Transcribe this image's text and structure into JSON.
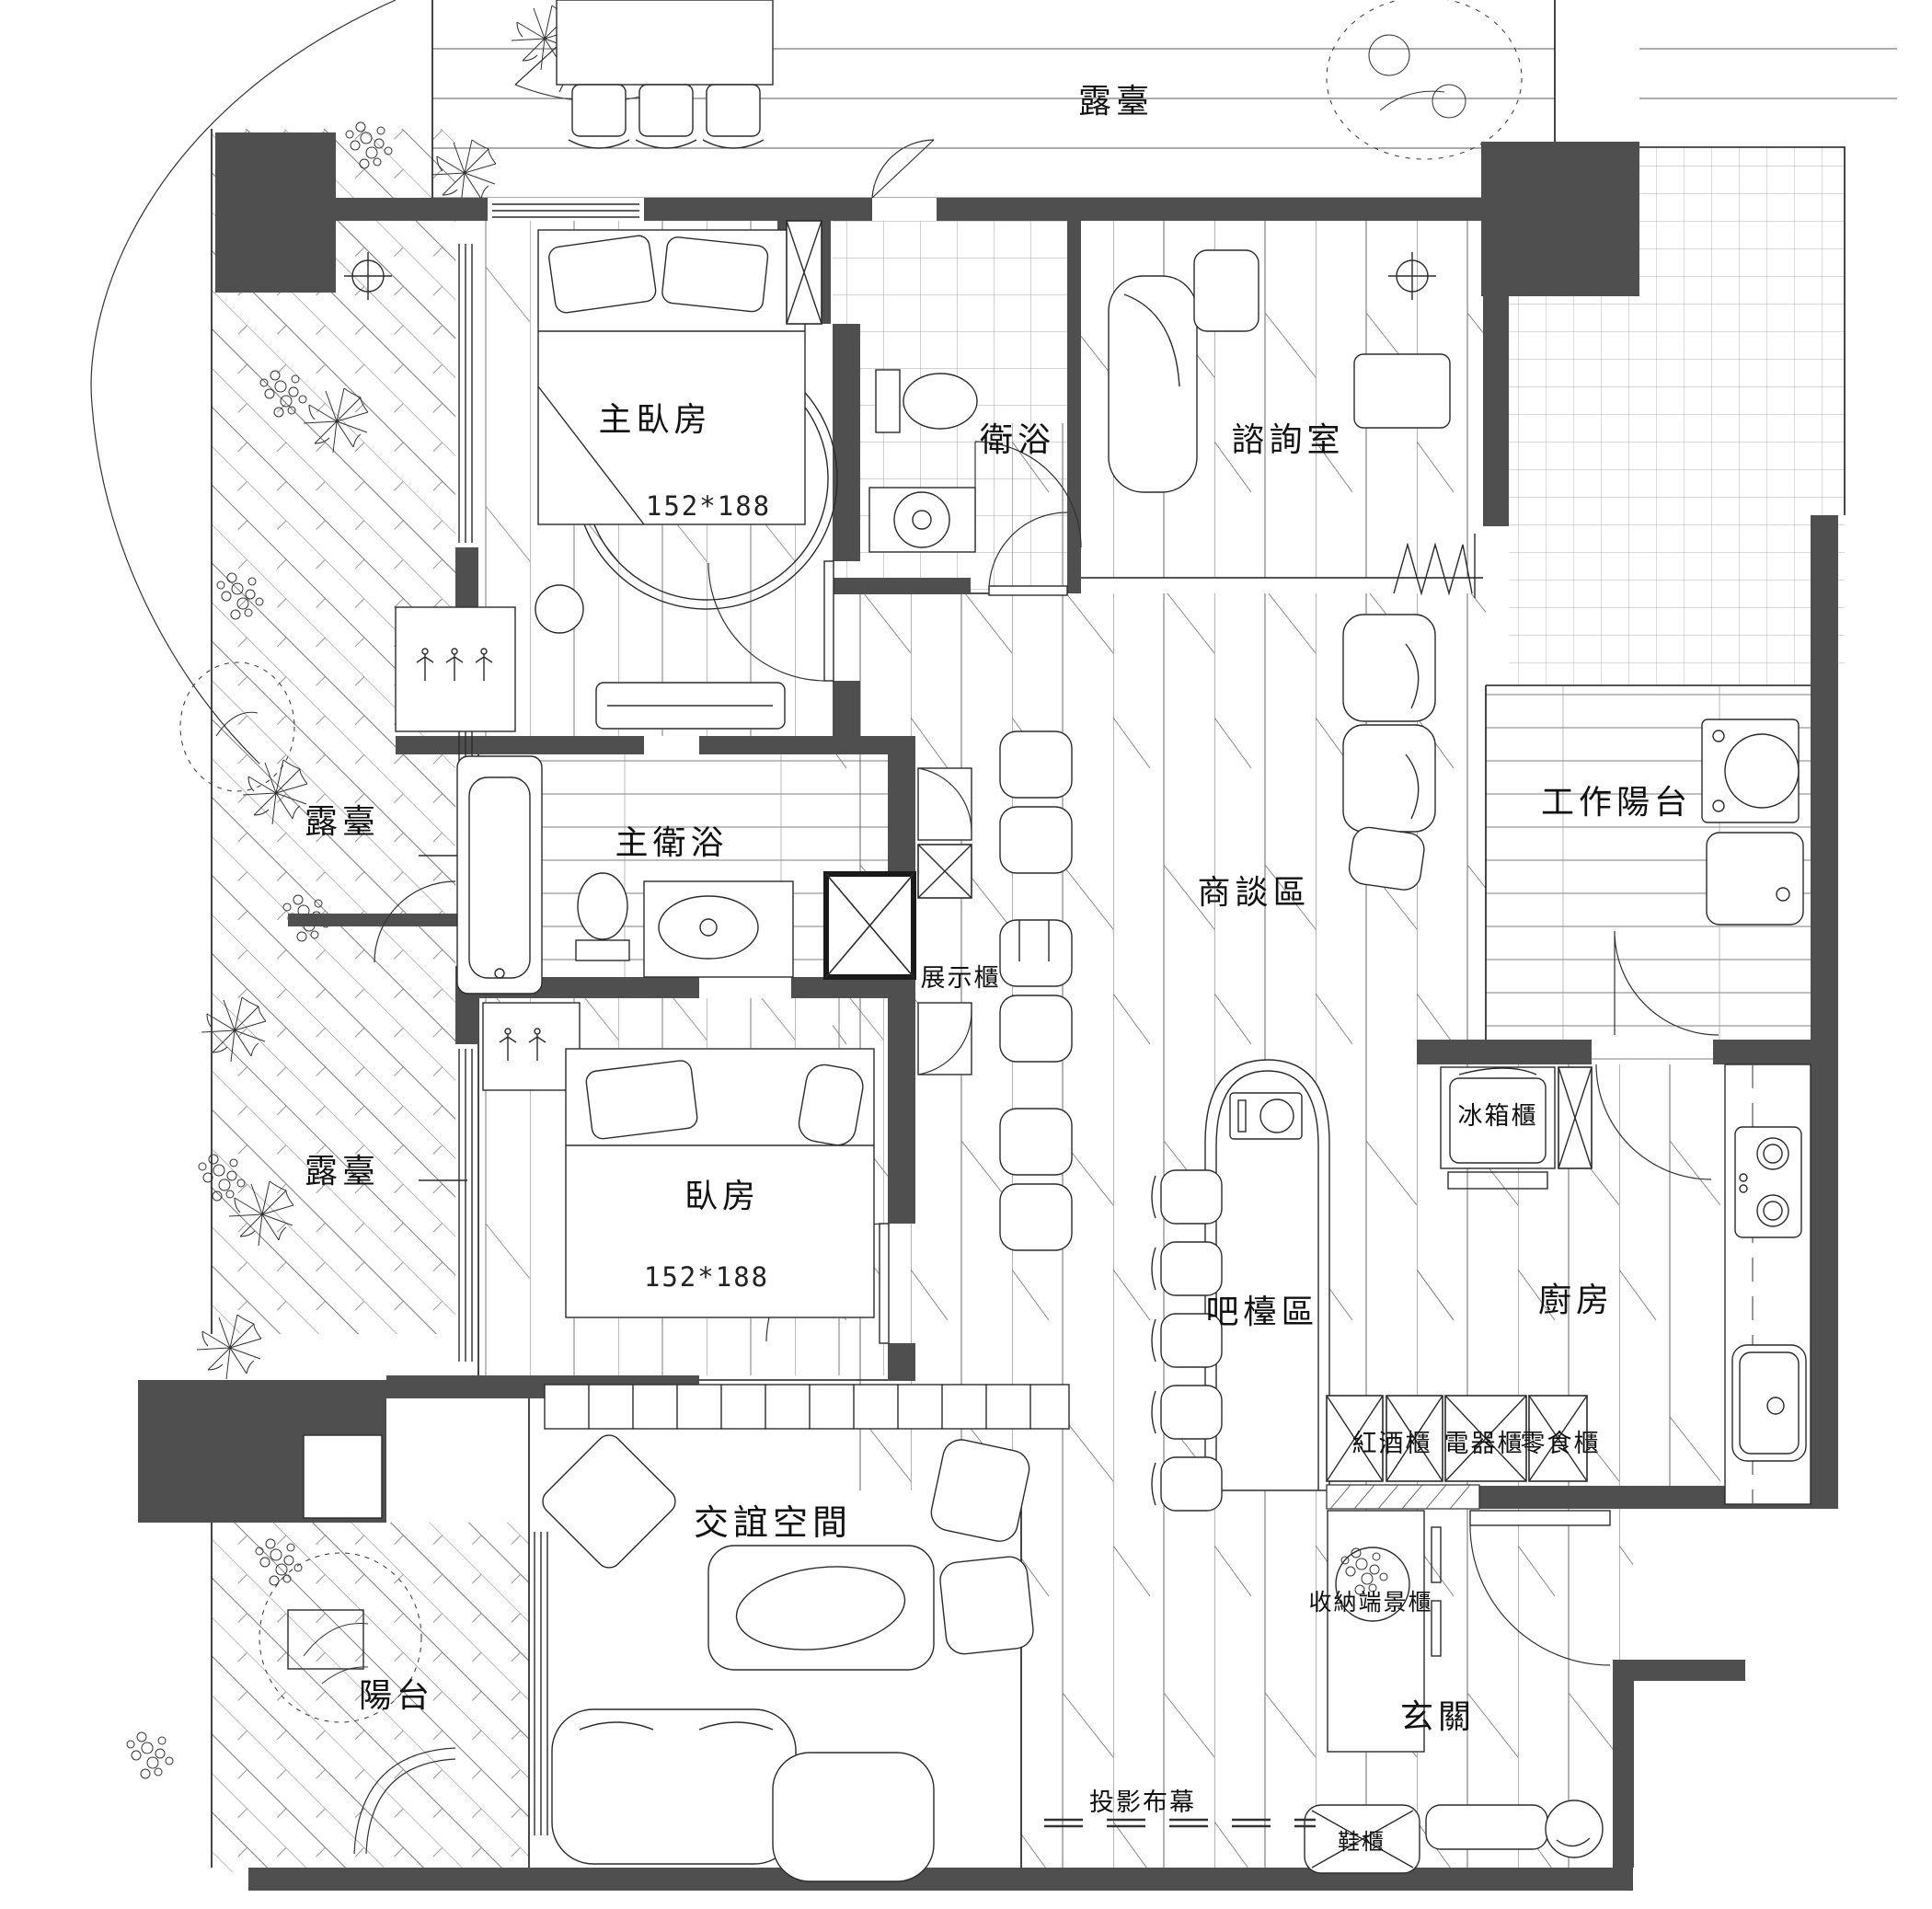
{
  "document": {
    "type": "interior-floor-plan",
    "units_note": "cm",
    "colors": {
      "paper": "#ffffff",
      "wall_fill": "#4f4f4f",
      "line": "#1a1a1a",
      "hatch": "#8c8c8c"
    }
  },
  "labels": {
    "terrace_top": "露臺",
    "master_bedroom": "主臥房",
    "master_bed_dim": "152*188",
    "bathroom": "衛浴",
    "consult_room": "諮詢室",
    "terrace_left_upper": "露臺",
    "master_bath": "主衛浴",
    "work_balcony": "工作陽台",
    "discussion_area": "商談區",
    "display_cabinet": "展示櫃",
    "terrace_left_lower": "露臺",
    "bedroom": "臥房",
    "bedroom_bed_dim": "152*188",
    "fridge_cabinet": "冰箱櫃",
    "bar_area": "吧檯區",
    "kitchen": "廚房",
    "wine_cabinet": "紅酒櫃",
    "appliance_cabinet": "電器櫃",
    "snack_cabinet": "零食櫃",
    "social_space": "交誼空間",
    "storage_view_cabinet": "收納端景櫃",
    "entry": "玄關",
    "balcony": "陽台",
    "projector_screen": "投影布幕",
    "shoe_cabinet": "鞋櫃"
  }
}
